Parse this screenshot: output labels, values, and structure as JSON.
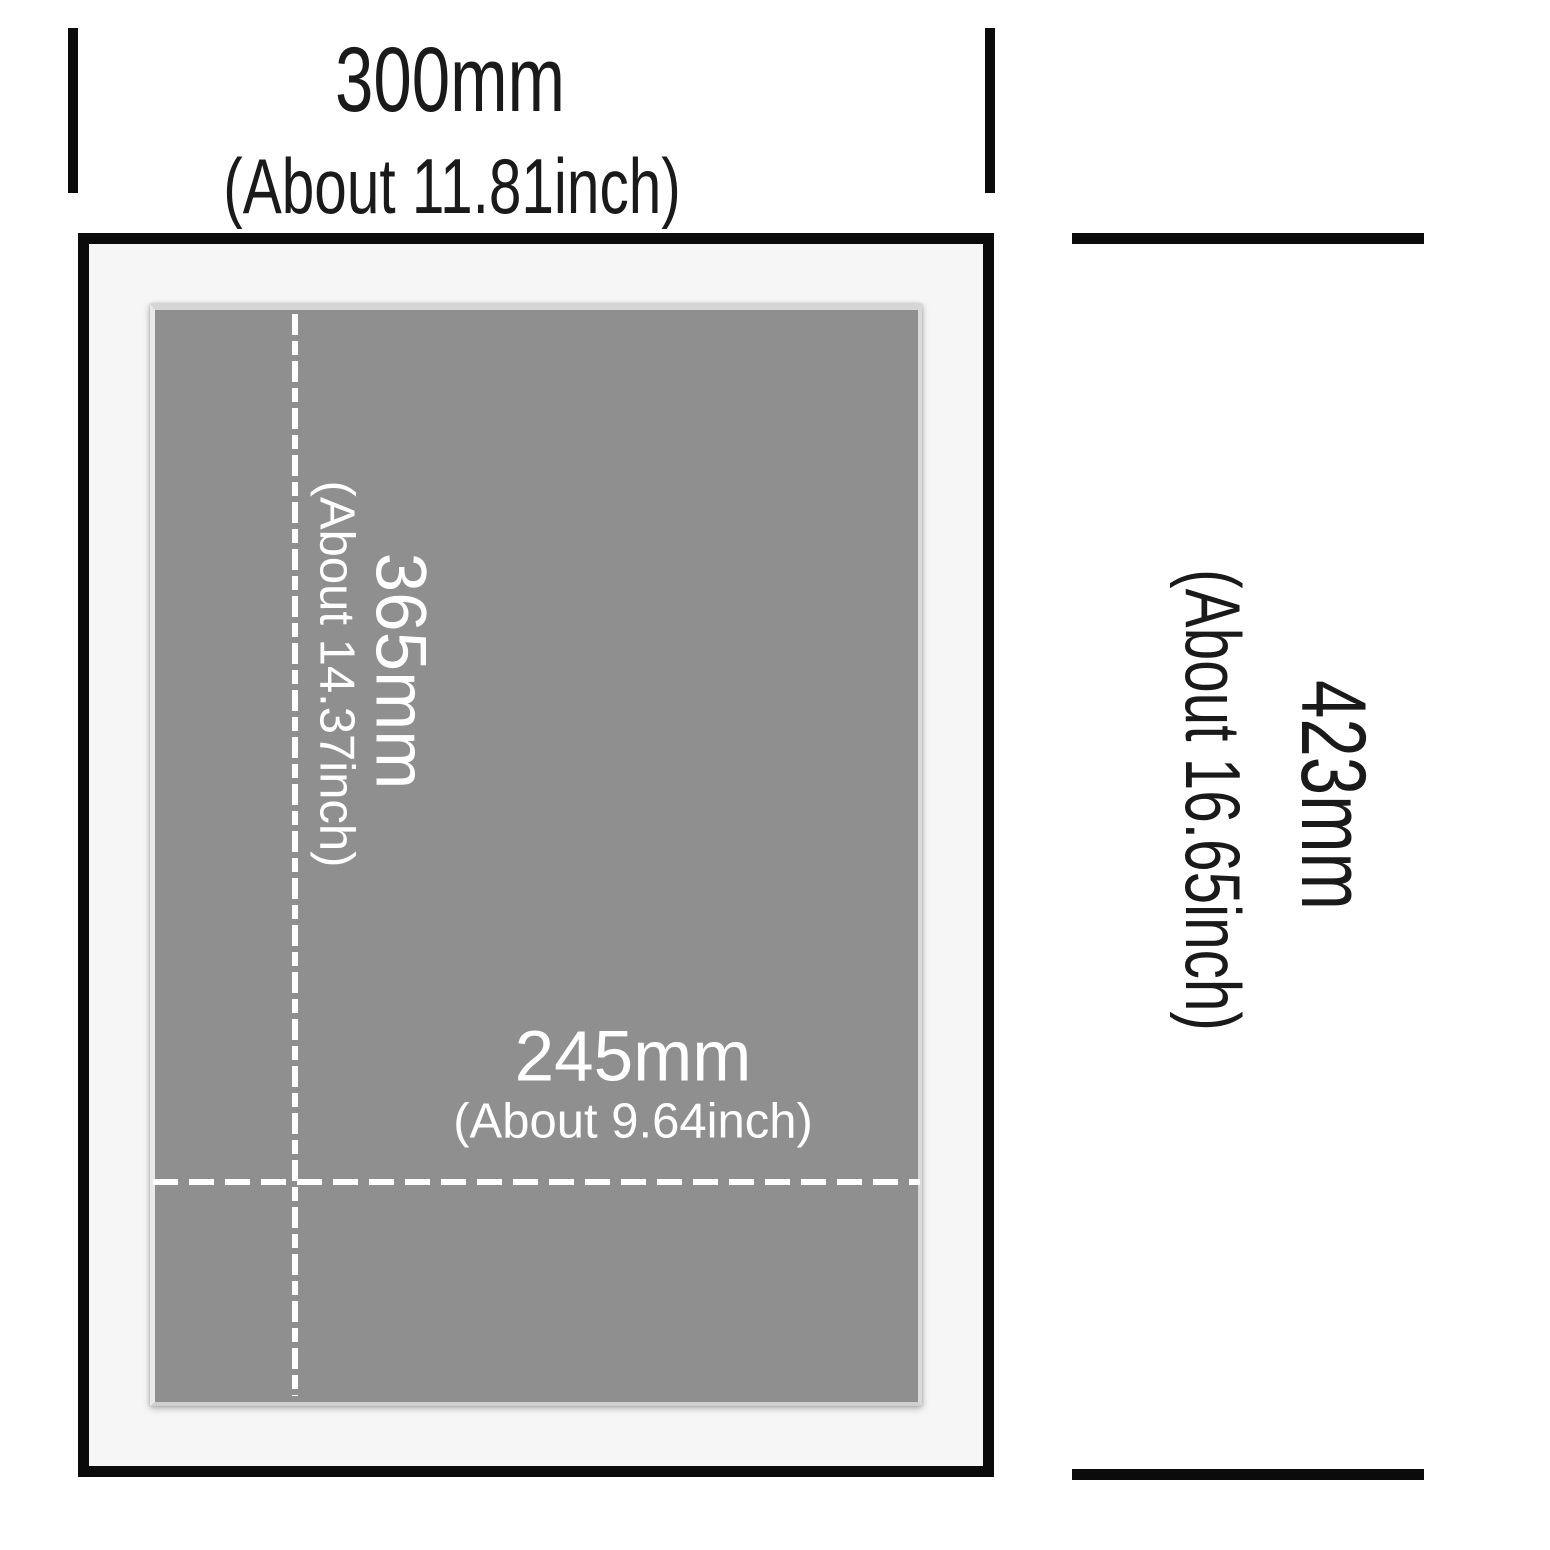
{
  "diagram_type": "picture-frame-dimension-diagram",
  "labels": {
    "outer_width": {
      "main": "300mm",
      "sub": "(About 11.81inch)"
    },
    "outer_height": {
      "main": "423mm",
      "sub": "(About 16.65inch)"
    },
    "opening_height": {
      "main": "365mm",
      "sub": "(About 14.37inch)"
    },
    "opening_width": {
      "main": "245mm",
      "sub": "(About 9.64inch)"
    }
  },
  "colors": {
    "background": "#ffffff",
    "frame_black": "#0b0b0b",
    "mat_white": "#f6f6f6",
    "photo_gray": "#8f8f8f",
    "guide_line": "#ffffff",
    "text_dark": "#1a1a1a",
    "text_light": "#ffffff"
  }
}
